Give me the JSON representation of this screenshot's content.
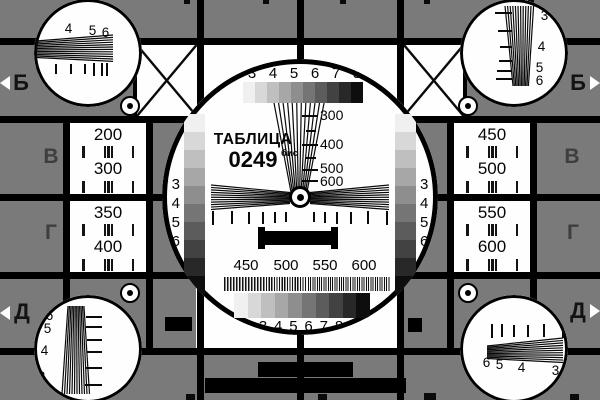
{
  "card": {
    "title": "ТАБЛИЦА",
    "number": "0249",
    "number_suffix": "бис"
  },
  "colors": {
    "background": "#7a7a7a",
    "black": "#000000",
    "white": "#fefefe",
    "marker_dark": "#131313",
    "marker_gray": "#3e3e3e",
    "grayscale_steps": [
      "#f0f0f0",
      "#d8d8d8",
      "#bfbfbf",
      "#a7a7a7",
      "#8e8e8e",
      "#757575",
      "#5c5c5c",
      "#424242",
      "#282828",
      "#0e0e0e"
    ]
  },
  "grayscale": {
    "top_labels": [
      "3",
      "4",
      "5",
      "6",
      "7",
      "8"
    ],
    "bottom_labels": [
      "3",
      "4",
      "5",
      "6",
      "7",
      "8"
    ],
    "left_labels": [
      "3",
      "4",
      "5",
      "6",
      "7",
      "8"
    ],
    "right_labels": [
      "3",
      "4",
      "5",
      "6",
      "7",
      "8"
    ]
  },
  "frequencies": {
    "wedge_labels": [
      "300",
      "400",
      "500",
      "600"
    ],
    "burst_labels": [
      "450",
      "500",
      "550",
      "600"
    ]
  },
  "resolution_cells": {
    "left_top": [
      "200",
      "300"
    ],
    "left_bottom": [
      "350",
      "400"
    ],
    "right_top": [
      "450",
      "500"
    ],
    "right_bottom": [
      "550",
      "600"
    ]
  },
  "row_markers": {
    "left": [
      "Б",
      "В",
      "Г",
      "Д"
    ],
    "right": [
      "Б",
      "В",
      "Г",
      "Д"
    ]
  },
  "corner_wedge_labels": {
    "top_left": [
      "3",
      "4",
      "5",
      "6"
    ],
    "top_right": [
      "3",
      "4",
      "5",
      "6"
    ],
    "bottom_left": [
      "6",
      "5",
      "4",
      "3"
    ],
    "bottom_right": [
      "6",
      "5",
      "4",
      "3"
    ]
  }
}
